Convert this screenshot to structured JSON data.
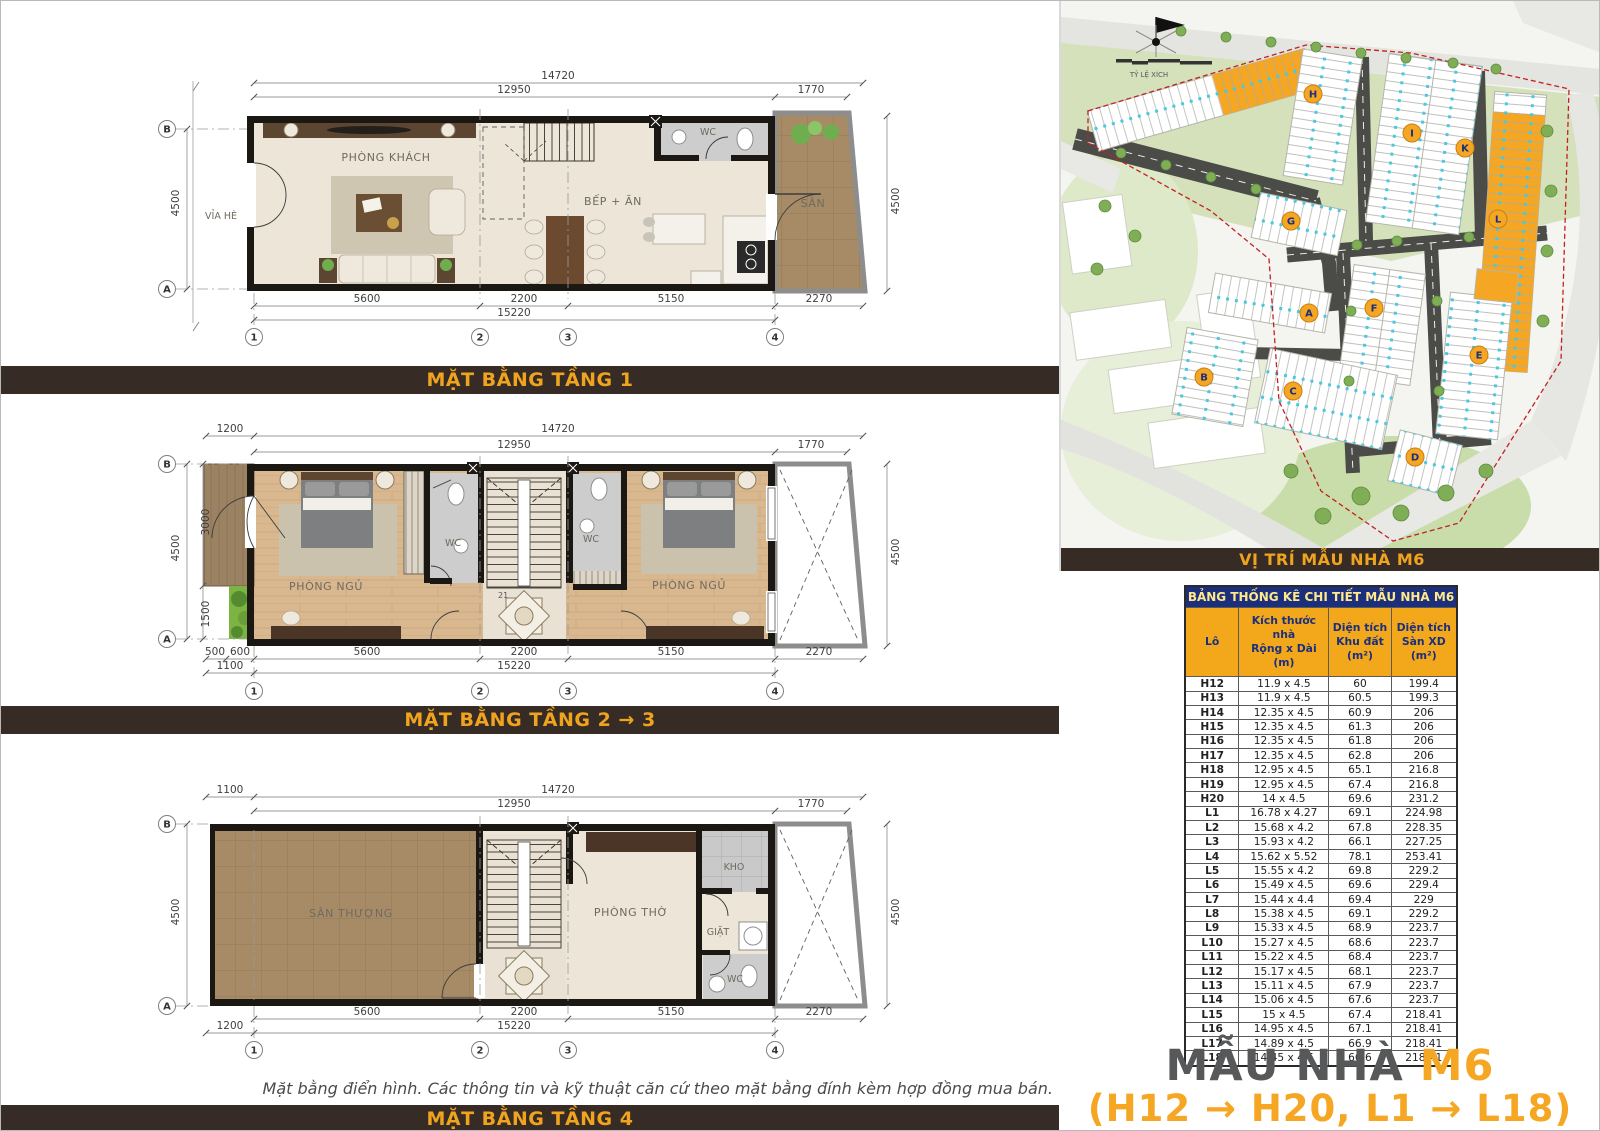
{
  "plans": {
    "p1": {
      "title": "MẶT BẰNG TẦNG 1",
      "rooms": {
        "living": "PHÒNG KHÁCH",
        "kitchen": "BẾP + ĂN",
        "wc": "WC",
        "yard": "SÂN",
        "sidewalk": "VỈA HÈ"
      }
    },
    "p23": {
      "title": "MẶT BẰNG TẦNG 2 → 3",
      "rooms": {
        "bed1": "PHÒNG NGỦ",
        "bed2": "PHÒNG NGỦ",
        "wc1": "WC",
        "wc2": "WC",
        "stair_note": "21"
      }
    },
    "p4": {
      "title": "MẶT BẰNG TẦNG 4",
      "rooms": {
        "terrace": "SÂN THƯỢNG",
        "worship": "PHÒNG THỜ",
        "storage": "KHO",
        "laundry": "GIẶT",
        "wc": "WC"
      }
    },
    "grid": {
      "A": "A",
      "B": "B",
      "n1": "1",
      "n2": "2",
      "n3": "3",
      "n4": "4"
    },
    "dims": {
      "d14720": "14720",
      "d12950": "12950",
      "d1770": "1770",
      "d4500": "4500",
      "d5600": "5600",
      "d2200": "2200",
      "d5150": "5150",
      "d15220": "15220",
      "d2270": "2270",
      "d1200": "1200",
      "d1100": "1100",
      "d500": "500",
      "d600": "600",
      "d3000": "3000",
      "d1500": "1500"
    }
  },
  "footnote": "Mặt bằng điển hình. Các thông tin và kỹ thuật căn cứ theo mặt bằng đính kèm hợp đồng mua bán.",
  "map": {
    "title": "VỊ TRÍ MẪU NHÀ M6",
    "scale_label": "TỶ LỆ XÍCH",
    "markers": [
      "H",
      "I",
      "K",
      "L",
      "G",
      "A",
      "F",
      "B",
      "C",
      "E",
      "D"
    ]
  },
  "table": {
    "title": "BẢNG THỐNG KÊ CHI TIẾT MẪU NHÀ M6",
    "col0": "Lô",
    "col1a": "Kích thước nhà",
    "col1b": "Rộng x Dài (m)",
    "col2a": "Diện tích",
    "col2b": "Khu đất (m²)",
    "col3a": "Diện tích",
    "col3b": "Sàn XD (m²)",
    "rows": [
      [
        "H12",
        "11.9 x 4.5",
        "60",
        "199.4"
      ],
      [
        "H13",
        "11.9 x 4.5",
        "60.5",
        "199.3"
      ],
      [
        "H14",
        "12.35 x 4.5",
        "60.9",
        "206"
      ],
      [
        "H15",
        "12.35 x 4.5",
        "61.3",
        "206"
      ],
      [
        "H16",
        "12.35 x 4.5",
        "61.8",
        "206"
      ],
      [
        "H17",
        "12.35 x 4.5",
        "62.8",
        "206"
      ],
      [
        "H18",
        "12.95 x 4.5",
        "65.1",
        "216.8"
      ],
      [
        "H19",
        "12.95 x 4.5",
        "67.4",
        "216.8"
      ],
      [
        "H20",
        "14 x 4.5",
        "69.6",
        "231.2"
      ],
      [
        "L1",
        "16.78 x 4.27",
        "69.1",
        "224.98"
      ],
      [
        "L2",
        "15.68 x 4.2",
        "67.8",
        "228.35"
      ],
      [
        "L3",
        "15.93 x 4.2",
        "66.1",
        "227.25"
      ],
      [
        "L4",
        "15.62 x 5.52",
        "78.1",
        "253.41"
      ],
      [
        "L5",
        "15.55 x 4.2",
        "69.8",
        "229.2"
      ],
      [
        "L6",
        "15.49 x 4.5",
        "69.6",
        "229.4"
      ],
      [
        "L7",
        "15.44 x 4.4",
        "69.4",
        "229"
      ],
      [
        "L8",
        "15.38 x 4.5",
        "69.1",
        "229.2"
      ],
      [
        "L9",
        "15.33 x 4.5",
        "68.9",
        "223.7"
      ],
      [
        "L10",
        "15.27 x 4.5",
        "68.6",
        "223.7"
      ],
      [
        "L11",
        "15.22 x 4.5",
        "68.4",
        "223.7"
      ],
      [
        "L12",
        "15.17 x 4.5",
        "68.1",
        "223.7"
      ],
      [
        "L13",
        "15.11 x 4.5",
        "67.9",
        "223.7"
      ],
      [
        "L14",
        "15.06 x 4.5",
        "67.6",
        "223.7"
      ],
      [
        "L15",
        "15 x 4.5",
        "67.4",
        "218.41"
      ],
      [
        "L16",
        "14.95 x 4.5",
        "67.1",
        "218.41"
      ],
      [
        "L17",
        "14.89 x 4.5",
        "66.9",
        "218.41"
      ],
      [
        "L18",
        "14.45 x 4.5",
        "66.6",
        "218.41"
      ]
    ]
  },
  "brand": {
    "name": "MẪU NHÀ",
    "model": "M6",
    "range": "(H12 → H20, L1 → L18)"
  },
  "colors": {
    "bar_bg": "#362c25",
    "bar_text": "#f0a41e",
    "navy": "#1b2f7d",
    "header_orange": "#f3a81c",
    "highlight": "#f5a623",
    "boundary_red": "#c22222"
  }
}
